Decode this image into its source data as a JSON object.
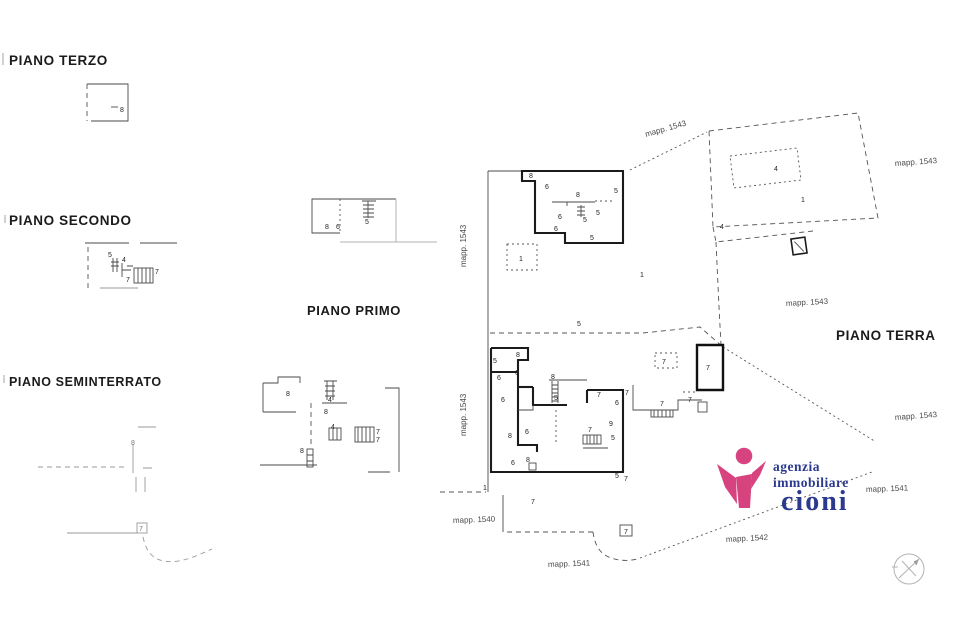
{
  "floors": {
    "terzo": "PIANO TERZO",
    "secondo": "PIANO SECONDO",
    "primo": "PIANO PRIMO",
    "seminterrato": "PIANO SEMINTERRATO",
    "terra": "PIANO TERRA"
  },
  "parcels": {
    "m1540": "mapp. 1540",
    "m1541": "mapp. 1541",
    "m1542": "mapp. 1542",
    "m1543": "mapp. 1543"
  },
  "rooms": {
    "n1": "1",
    "n4": "4",
    "n5": "5",
    "n6": "6",
    "n7": "7",
    "n8": "8",
    "n9": "9"
  },
  "logo": {
    "line1": "agenzia",
    "line2": "immobiliare",
    "line3": "cioni",
    "pink": "#d6437f",
    "blue": "#2b3a8e"
  }
}
